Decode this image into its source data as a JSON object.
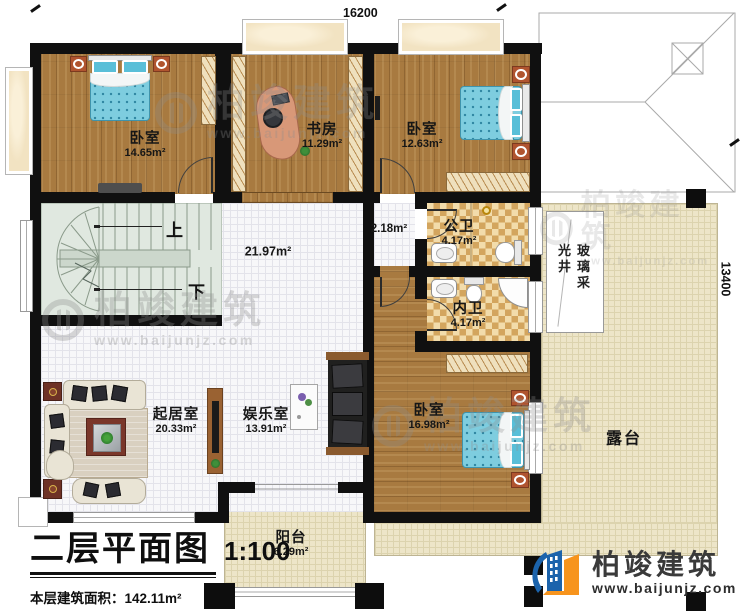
{
  "title_block": {
    "title": "二层平面图",
    "scale": "1:100",
    "area_label": "本层建筑面积：",
    "area_value": "142.11m²",
    "floor_height_label": "层高：",
    "floor_height_value": "3.3m"
  },
  "dimensions": {
    "top": "16200",
    "right": "13400"
  },
  "rooms": [
    {
      "id": "bedroom-1",
      "name": "卧室",
      "area": "14.65m²"
    },
    {
      "id": "study",
      "name": "书房",
      "area": "11.29m²"
    },
    {
      "id": "bedroom-2",
      "name": "卧室",
      "area": "12.63m²"
    },
    {
      "id": "hall",
      "name": "",
      "area": "21.97m²"
    },
    {
      "id": "corridor",
      "name": "",
      "area": "2.18m²"
    },
    {
      "id": "public-bath",
      "name": "公卫",
      "area": "4.17m²"
    },
    {
      "id": "ensuite-bath",
      "name": "内卫",
      "area": "4.17m²"
    },
    {
      "id": "bedroom-3",
      "name": "卧室",
      "area": "16.98m²"
    },
    {
      "id": "living-room",
      "name": "起居室",
      "area": "20.33m²"
    },
    {
      "id": "entertainment",
      "name": "娱乐室",
      "area": "13.91m²"
    },
    {
      "id": "balcony",
      "name": "阳台",
      "area": "6.29m²"
    },
    {
      "id": "terrace",
      "name": "露台",
      "area": ""
    },
    {
      "id": "skylight",
      "name": "玻璃采光井",
      "area": ""
    }
  ],
  "stairs": {
    "up_label": "上",
    "down_label": "下"
  },
  "branding": {
    "company": "柏竣建筑",
    "website": "www.baijunjz.com"
  },
  "colors": {
    "wall": "#101010",
    "wood": "#a87a40",
    "bath_tile": "#d3a55e",
    "terrace": "#ede5c8",
    "brand_blue": "#1b63ac",
    "brand_orange": "#f7941d"
  }
}
